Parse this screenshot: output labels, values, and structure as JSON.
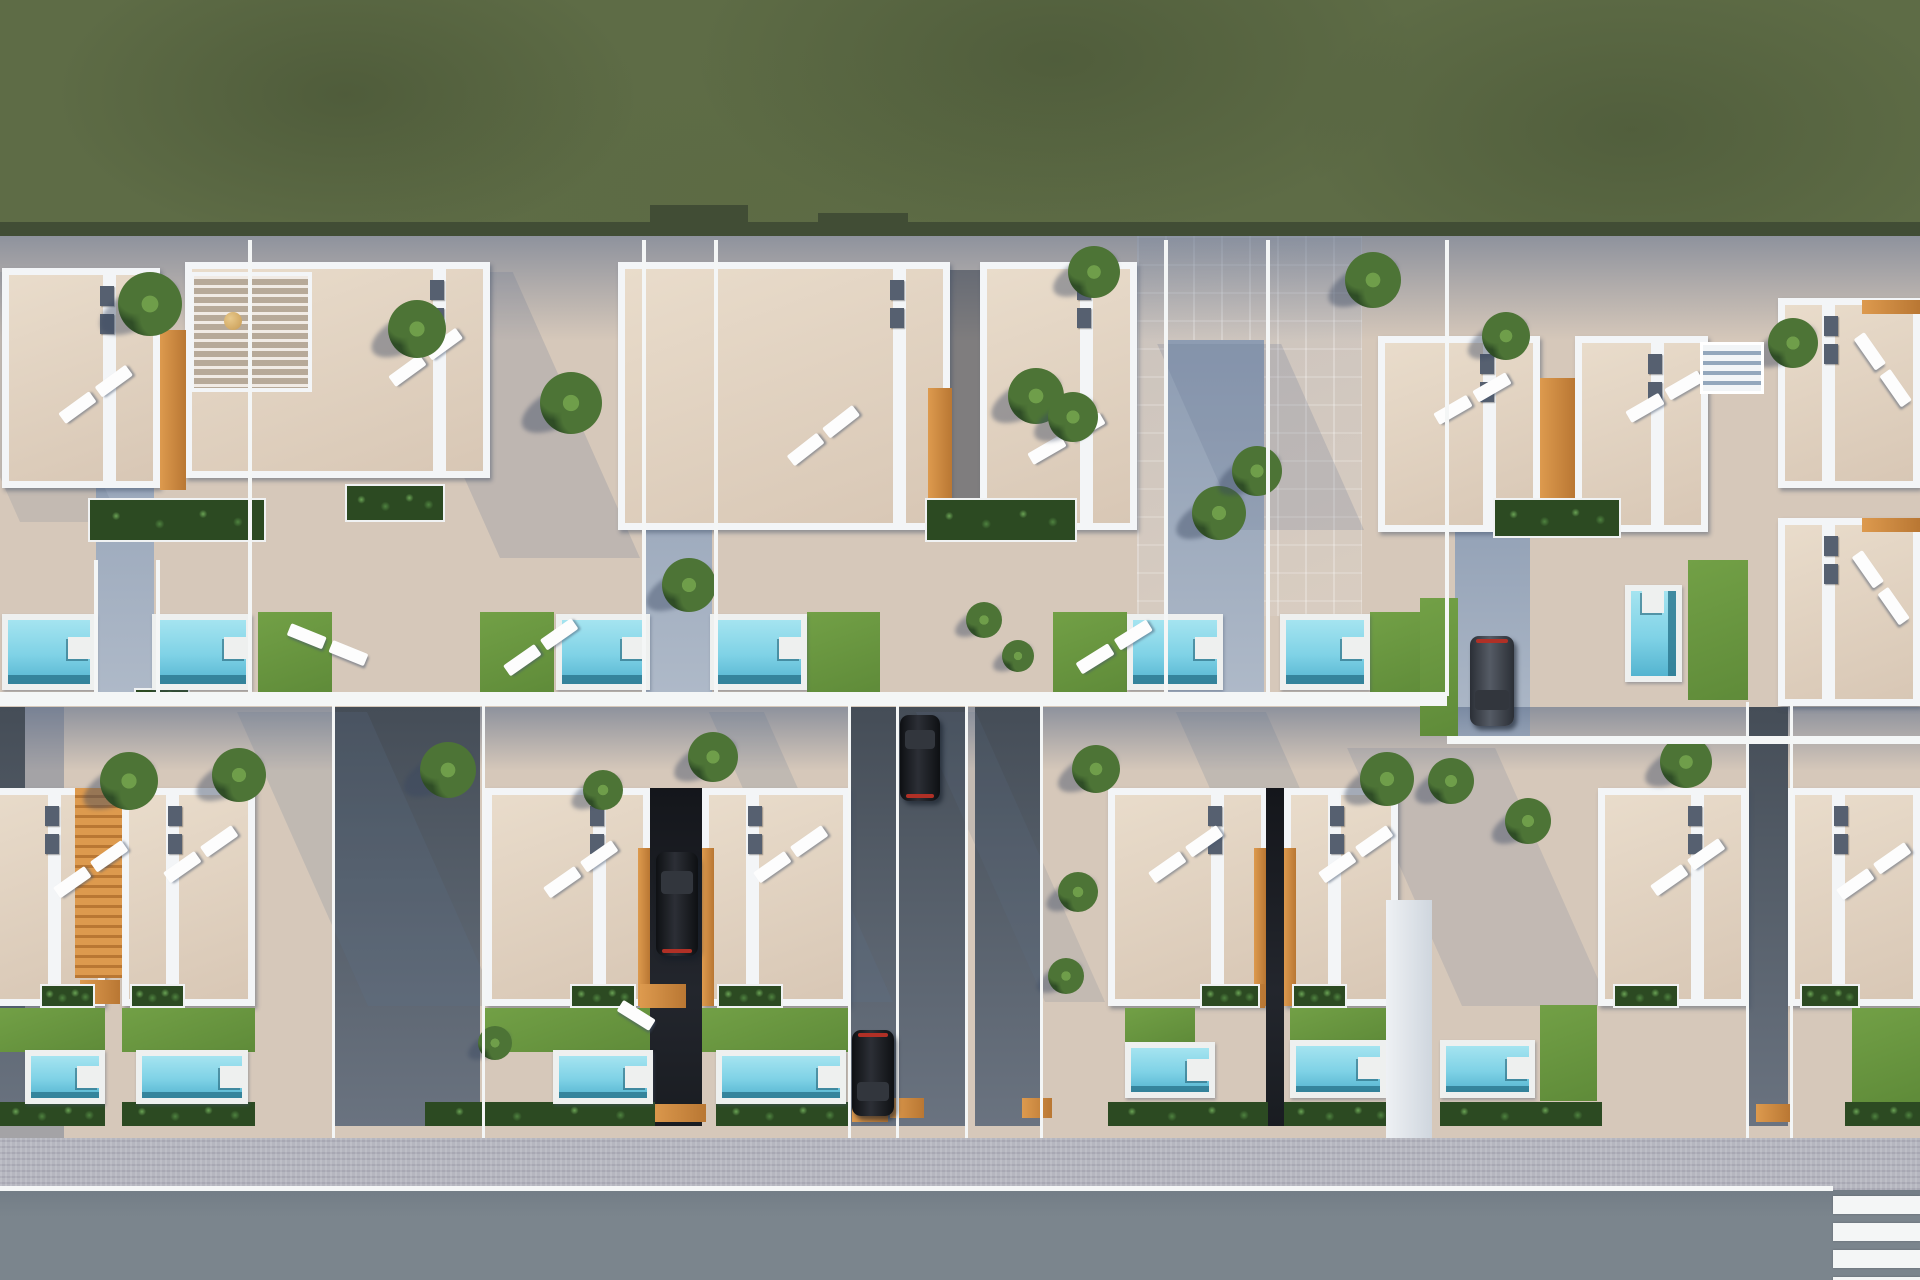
{
  "meta": {
    "title": "Aerial 3D render of a residential villa development",
    "type": "architectural-render-top-view",
    "caption": "Top-down 3D visualization: two rows of semi-detached white villas with roof terraces, sun loungers, private pools and lawns, driveways with parked cars, green field above, sidewalk and asphalt road with pedestrian crossing below."
  },
  "palette": {
    "beige": "#d6c8ba",
    "grass": "#5e6c46",
    "grassEdge": "#414d35",
    "wall": "#f3f5f7",
    "terr": "#d8c7b5",
    "terrLight": "#e9dccb",
    "vent": "#566070",
    "orange": "#dd9a4e",
    "orangeDark": "#b97733",
    "plantDark": "#2c4a22",
    "plantMid": "#4f8340",
    "plantLight": "#6aa355",
    "lawn": "#5f8b39",
    "lawnLight": "#72a046",
    "poolDeck": "#eef0ef",
    "water1": "#a5e4f0",
    "water2": "#7fd2e6",
    "water3": "#54b4d0",
    "waterDark": "#2e7a92",
    "driveDark": "#454d57",
    "drive": "#545d68",
    "driveLight": "#6a7380",
    "sidewalk": "#b5b6bf",
    "road": "#7b858d",
    "white": "#f4f6f6",
    "carWin": "#32363d",
    "tail": "#b03026",
    "palm1": "#2f4d26",
    "palm2": "#4d7436",
    "palm3": "#6f9e4a"
  },
  "scene": {
    "width": 1920,
    "height": 1280
  },
  "grass": {
    "rect": [
      0,
      0,
      1920,
      236
    ],
    "edge": [
      0,
      222,
      1920,
      14
    ],
    "notches": [
      [
        650,
        205,
        98,
        31
      ],
      [
        818,
        213,
        90,
        23
      ]
    ]
  },
  "bands": [
    {
      "rect": [
        0,
        236,
        1920,
        105
      ]
    },
    {
      "rect": [
        0,
        707,
        1920,
        64
      ]
    }
  ],
  "col_shadows": [
    [
      0,
      707,
      64,
      431
    ]
  ],
  "walkways": [
    [
      96,
      340,
      58,
      352
    ],
    [
      644,
      340,
      68,
      352
    ],
    [
      1168,
      340,
      96,
      352
    ],
    [
      1455,
      470,
      75,
      268
    ]
  ],
  "patios": [
    [
      1137,
      236,
      225,
      380
    ]
  ],
  "house_shadows": [
    [
      500,
      272,
      140,
      286,
      0.45
    ],
    [
      20,
      272,
      100,
      250,
      0.35
    ],
    [
      860,
      272,
      95,
      250,
      0.4
    ],
    [
      1240,
      344,
      124,
      186,
      0.45
    ],
    [
      368,
      712,
      130,
      294,
      0.4
    ],
    [
      838,
      712,
      55,
      290,
      0.4
    ],
    [
      1045,
      712,
      60,
      290,
      0.35
    ],
    [
      1305,
      712,
      90,
      290,
      0.4
    ],
    [
      1462,
      748,
      148,
      258,
      0.38
    ]
  ],
  "dark_strips": [
    [
      950,
      270,
      30,
      262
    ]
  ],
  "houses": [
    {
      "r": [
        2,
        268,
        158,
        220
      ],
      "part": "right"
    },
    {
      "r": [
        185,
        262,
        305,
        216
      ],
      "part": "right",
      "pergola": [
        190,
        272,
        122,
        120
      ],
      "table": [
        224,
        312,
        18
      ]
    },
    {
      "r": [
        618,
        262,
        332,
        268
      ],
      "part": "right"
    },
    {
      "r": [
        980,
        262,
        157,
        268
      ],
      "part": "right"
    },
    {
      "r": [
        1378,
        336,
        162,
        196
      ],
      "part": "right"
    },
    {
      "r": [
        1575,
        336,
        133,
        196
      ],
      "part": "right"
    },
    {
      "r": [
        1778,
        298,
        142,
        190
      ],
      "part": "left"
    },
    {
      "r": [
        1778,
        518,
        142,
        188
      ],
      "part": "left"
    },
    {
      "r": [
        -55,
        788,
        160,
        218
      ],
      "part": "right"
    },
    {
      "r": [
        122,
        788,
        133,
        218
      ],
      "part": "left"
    },
    {
      "r": [
        485,
        788,
        165,
        218
      ],
      "part": "right"
    },
    {
      "r": [
        702,
        788,
        148,
        218
      ],
      "part": "left"
    },
    {
      "r": [
        1108,
        788,
        160,
        218
      ],
      "part": "right"
    },
    {
      "r": [
        1284,
        788,
        114,
        218
      ],
      "part": "left"
    },
    {
      "r": [
        1598,
        788,
        150,
        218
      ],
      "part": "right"
    },
    {
      "r": [
        1788,
        788,
        132,
        218
      ],
      "part": "left"
    }
  ],
  "gaps": [
    {
      "r": [
        650,
        788,
        52,
        338
      ],
      "kind": "black"
    },
    {
      "r": [
        1266,
        788,
        18,
        338
      ],
      "kind": "black"
    },
    {
      "r": [
        75,
        788,
        47,
        190
      ],
      "kind": "orange"
    }
  ],
  "orange_strips": [
    [
      160,
      330,
      26,
      160
    ],
    [
      928,
      388,
      24,
      140
    ],
    [
      1540,
      378,
      35,
      152
    ],
    [
      1862,
      300,
      58,
      14
    ],
    [
      1862,
      518,
      58,
      14
    ],
    [
      638,
      848,
      12,
      158
    ],
    [
      702,
      848,
      12,
      158
    ],
    [
      1254,
      848,
      12,
      158
    ],
    [
      1284,
      848,
      12,
      158
    ],
    [
      640,
      984,
      46,
      24
    ],
    [
      1225,
      984,
      40,
      24
    ],
    [
      80,
      980,
      40,
      24
    ],
    [
      440,
      1104,
      40,
      18
    ],
    [
      650,
      1104,
      56,
      18
    ],
    [
      852,
      1104,
      36,
      18
    ],
    [
      890,
      1098,
      34,
      20
    ],
    [
      1022,
      1098,
      30,
      20
    ],
    [
      1340,
      1104,
      42,
      18
    ],
    [
      1756,
      1104,
      34,
      18
    ]
  ],
  "planters": [
    [
      88,
      498,
      178,
      44
    ],
    [
      925,
      498,
      152,
      44
    ],
    [
      1493,
      498,
      128,
      40
    ],
    [
      345,
      484,
      100,
      38
    ],
    [
      134,
      688,
      56,
      18
    ],
    [
      40,
      984,
      55,
      24
    ],
    [
      130,
      984,
      55,
      24
    ],
    [
      570,
      984,
      66,
      24
    ],
    [
      717,
      984,
      66,
      24
    ],
    [
      1200,
      984,
      60,
      24
    ],
    [
      1292,
      984,
      55,
      24
    ],
    [
      1613,
      984,
      66,
      24
    ],
    [
      1800,
      984,
      60,
      24
    ]
  ],
  "loungers": [
    [
      60,
      385,
      -36,
      0
    ],
    [
      390,
      348,
      -36,
      0
    ],
    [
      788,
      426,
      -38,
      0
    ],
    [
      1030,
      430,
      -30,
      0
    ],
    [
      1436,
      390,
      -30,
      0
    ],
    [
      1628,
      388,
      -30,
      0
    ],
    [
      1832,
      360,
      55,
      0
    ],
    [
      1830,
      578,
      55,
      0
    ],
    [
      55,
      860,
      -35,
      0
    ],
    [
      165,
      845,
      -35,
      0
    ],
    [
      545,
      860,
      -35,
      0
    ],
    [
      755,
      845,
      -35,
      0
    ],
    [
      1150,
      845,
      -35,
      0
    ],
    [
      1320,
      845,
      -35,
      0
    ],
    [
      1652,
      858,
      -35,
      0
    ],
    [
      1838,
      862,
      -35,
      0
    ],
    [
      282,
      638,
      22,
      0
    ],
    [
      505,
      638,
      -35,
      0
    ],
    [
      1078,
      638,
      -32,
      0
    ],
    [
      608,
      1020,
      32,
      1
    ]
  ],
  "pools": [
    [
      2,
      614,
      94,
      76,
      0
    ],
    [
      152,
      614,
      100,
      76,
      0
    ],
    [
      556,
      614,
      94,
      76,
      0
    ],
    [
      710,
      614,
      97,
      76,
      0
    ],
    [
      1127,
      614,
      96,
      76,
      0
    ],
    [
      1280,
      614,
      90,
      76,
      0
    ],
    [
      1625,
      585,
      57,
      97,
      1
    ],
    [
      25,
      1050,
      80,
      54,
      0
    ],
    [
      136,
      1050,
      112,
      54,
      0
    ],
    [
      553,
      1050,
      100,
      54,
      0
    ],
    [
      716,
      1050,
      130,
      54,
      0
    ],
    [
      1125,
      1042,
      90,
      56,
      0
    ],
    [
      1290,
      1040,
      96,
      58,
      0
    ],
    [
      1440,
      1040,
      95,
      58,
      0
    ]
  ],
  "lawns": [
    [
      258,
      612,
      74,
      80
    ],
    [
      480,
      612,
      74,
      80
    ],
    [
      807,
      612,
      73,
      80
    ],
    [
      1053,
      612,
      74,
      80
    ],
    [
      1370,
      612,
      73,
      80
    ],
    [
      1420,
      598,
      38,
      138
    ],
    [
      1688,
      560,
      60,
      140
    ],
    [
      0,
      1008,
      105,
      44
    ],
    [
      122,
      1008,
      133,
      44
    ],
    [
      485,
      1008,
      165,
      44
    ],
    [
      702,
      1008,
      148,
      44
    ],
    [
      1125,
      1008,
      70,
      34
    ],
    [
      1290,
      1008,
      96,
      34
    ],
    [
      1540,
      1005,
      57,
      96
    ],
    [
      1852,
      1008,
      68,
      94
    ]
  ],
  "hedges": [
    [
      0,
      1102,
      105,
      24
    ],
    [
      122,
      1102,
      133,
      24
    ],
    [
      425,
      1102,
      230,
      24
    ],
    [
      716,
      1102,
      134,
      24
    ],
    [
      1108,
      1102,
      160,
      24
    ],
    [
      1284,
      1102,
      114,
      24
    ],
    [
      1440,
      1102,
      162,
      24
    ],
    [
      1845,
      1102,
      75,
      24
    ]
  ],
  "driveways": [
    [
      -10,
      707,
      35,
      419
    ],
    [
      335,
      707,
      145,
      419
    ],
    [
      850,
      707,
      48,
      419
    ],
    [
      898,
      707,
      67,
      419
    ],
    [
      975,
      707,
      65,
      419
    ],
    [
      1748,
      707,
      40,
      419
    ]
  ],
  "white_lines": [
    [
      0,
      692,
      1447,
      8
    ],
    [
      1447,
      736,
      473,
      8
    ],
    [
      0,
      700,
      1447,
      6
    ],
    [
      248,
      240,
      4,
      456
    ],
    [
      642,
      240,
      4,
      456
    ],
    [
      714,
      240,
      4,
      456
    ],
    [
      1164,
      240,
      4,
      456
    ],
    [
      1266,
      240,
      4,
      456
    ],
    [
      1445,
      240,
      4,
      456
    ],
    [
      94,
      560,
      4,
      134
    ],
    [
      156,
      560,
      4,
      134
    ],
    [
      332,
      702,
      3,
      436
    ],
    [
      482,
      702,
      3,
      436
    ],
    [
      848,
      702,
      3,
      436
    ],
    [
      896,
      702,
      3,
      436
    ],
    [
      965,
      702,
      3,
      436
    ],
    [
      1040,
      702,
      3,
      436
    ],
    [
      1746,
      702,
      3,
      436
    ],
    [
      1790,
      702,
      3,
      436
    ]
  ],
  "cars": [
    {
      "r": [
        656,
        852,
        42,
        104
      ],
      "color": "black",
      "tail": "bottom"
    },
    {
      "r": [
        852,
        1030,
        42,
        86
      ],
      "color": "black",
      "tail": "top"
    },
    {
      "r": [
        900,
        715,
        40,
        86
      ],
      "color": "black",
      "tail": "bottom"
    },
    {
      "r": [
        1470,
        636,
        44,
        90
      ],
      "color": "gray",
      "tail": "top"
    }
  ],
  "palms": [
    [
      118,
      272,
      64
    ],
    [
      388,
      300,
      58
    ],
    [
      540,
      372,
      62
    ],
    [
      662,
      558,
      54
    ],
    [
      1008,
      368,
      56
    ],
    [
      1048,
      392,
      50
    ],
    [
      1068,
      246,
      52
    ],
    [
      1192,
      486,
      54
    ],
    [
      1232,
      446,
      50
    ],
    [
      1345,
      252,
      56
    ],
    [
      966,
      602,
      36
    ],
    [
      1002,
      640,
      32
    ],
    [
      1482,
      312,
      48
    ],
    [
      1768,
      318,
      50
    ],
    [
      100,
      752,
      58
    ],
    [
      212,
      748,
      54
    ],
    [
      420,
      742,
      56
    ],
    [
      688,
      732,
      50
    ],
    [
      1072,
      745,
      48
    ],
    [
      1058,
      872,
      40
    ],
    [
      1048,
      958,
      36
    ],
    [
      1360,
      752,
      54
    ],
    [
      1428,
      758,
      46
    ],
    [
      1660,
      736,
      52
    ],
    [
      478,
      1026,
      34
    ],
    [
      1505,
      798,
      46
    ],
    [
      583,
      770,
      40
    ]
  ],
  "misc": {
    "stair_structure": [
      1700,
      342,
      64,
      52
    ],
    "wall_column": [
      1386,
      900,
      46,
      238
    ]
  },
  "street": {
    "sidewalk": [
      0,
      1138,
      1920,
      52
    ],
    "edge_line": [
      0,
      1186,
      1833,
      5
    ],
    "road": [
      0,
      1190,
      1920,
      90
    ],
    "crosswalk": {
      "x": 1833,
      "stripe_w": 87,
      "stripe_h": 18,
      "ys": [
        1196,
        1223,
        1250,
        1277
      ]
    }
  }
}
